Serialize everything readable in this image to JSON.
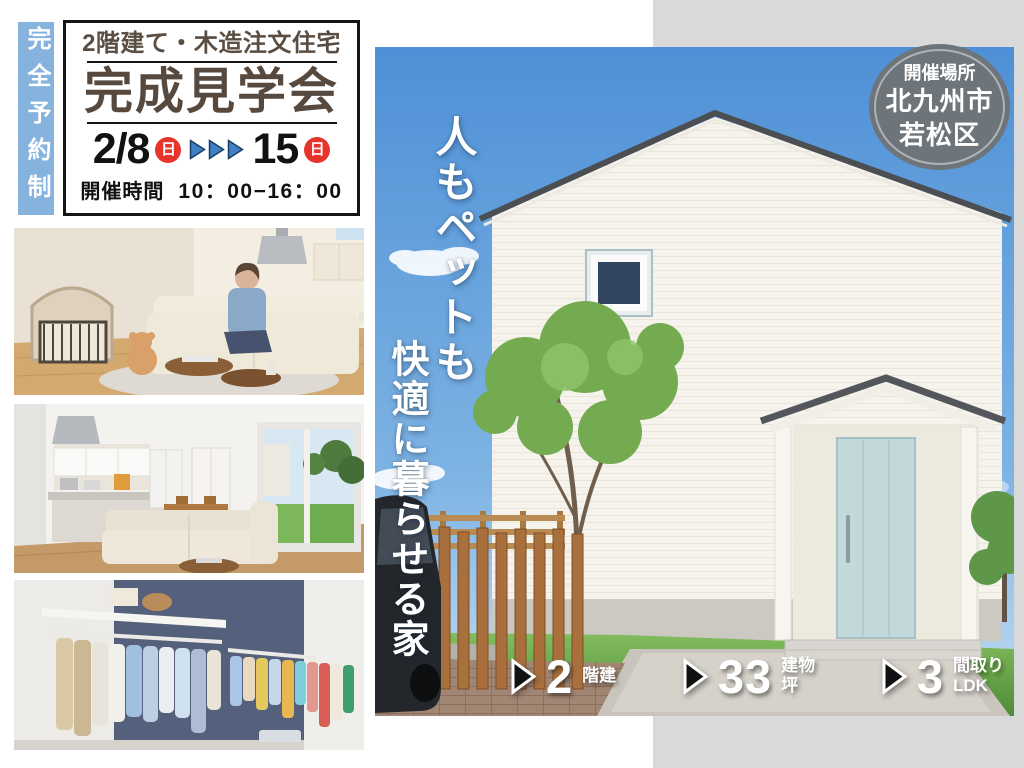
{
  "colors": {
    "banner_blue": "#85b3dd",
    "accent_red": "#e8352b",
    "arrow_blue": "#3f81c4",
    "title_brown": "#57493e",
    "badge_gray": "#6d747a",
    "panel_gray": "#d9d9d9",
    "door_blue": "#c3d8da"
  },
  "reservation": {
    "label": "完全予約制"
  },
  "event_box": {
    "subtitle": "2階建て・木造注文住宅",
    "title": "完成見学会",
    "date_start": "2/8",
    "date_start_day": "日",
    "date_end": "15",
    "date_end_day": "日",
    "time_label": "開催時間",
    "time_value": "10：00−16：00"
  },
  "venue_badge": {
    "label": "開催場所",
    "city": "北九州市",
    "ward": "若松区"
  },
  "catch_copy": {
    "line1": "人もペットも",
    "line2": "快適に暮らせる家"
  },
  "specs": [
    {
      "value": "2",
      "unit_lines": [
        "階建",
        ""
      ]
    },
    {
      "value": "33",
      "unit_lines": [
        "建物",
        "坪"
      ]
    },
    {
      "value": "3",
      "unit_lines": [
        "間取り",
        "LDK"
      ]
    }
  ],
  "icons": {
    "date_arrows": "triple-play-triangle-icon",
    "spec_marker": "play-triangle-icon"
  }
}
